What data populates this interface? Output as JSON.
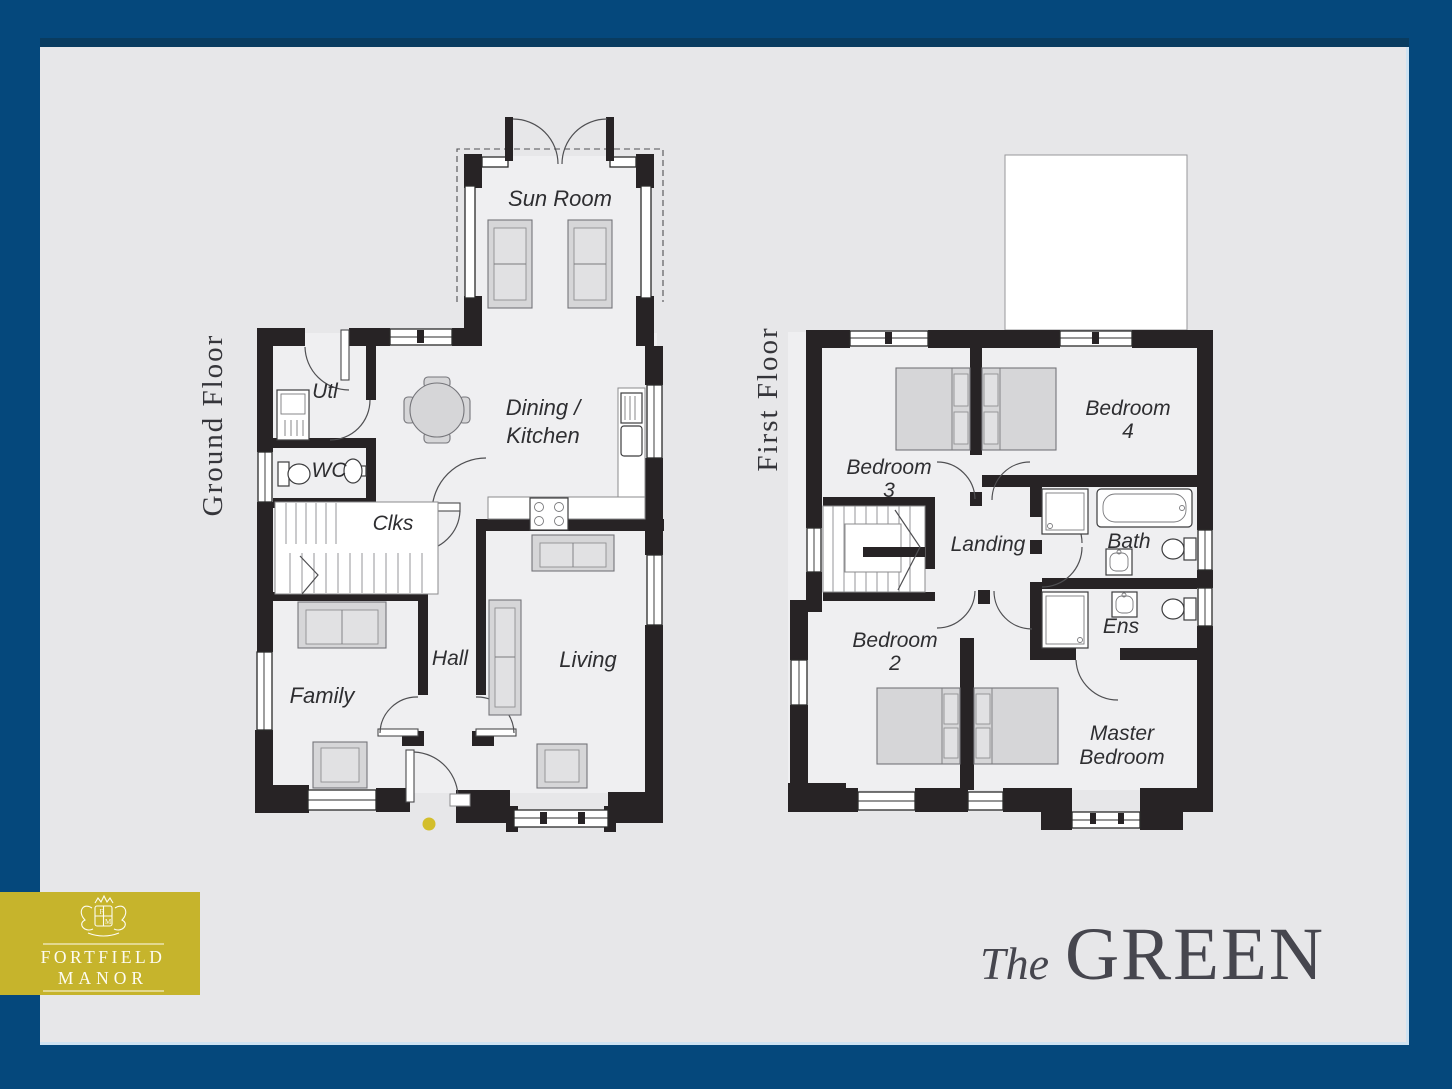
{
  "brand": {
    "name_line1": "FORTFIELD",
    "name_line2": "MANOR"
  },
  "plot": {
    "prefix": "The",
    "name": "GREEN"
  },
  "ground_floor": {
    "title": "Ground Floor",
    "sun_room": "Sun Room",
    "utility": "Utl",
    "wc": "WC",
    "cloaks": "Clks",
    "dining_kitchen_line1": "Dining /",
    "dining_kitchen_line2": "Kitchen",
    "hall": "Hall",
    "family": "Family",
    "living": "Living"
  },
  "first_floor": {
    "title": "First Floor",
    "bedroom3_line1": "Bedroom",
    "bedroom3_line2": "3",
    "bedroom4_line1": "Bedroom",
    "bedroom4_line2": "4",
    "landing": "Landing",
    "bath": "Bath",
    "bedroom2_line1": "Bedroom",
    "bedroom2_line2": "2",
    "ensuite": "Ens",
    "master_line1": "Master",
    "master_line2": "Bedroom"
  },
  "colors": {
    "frame_blue": "#05487c",
    "panel_grey": "#e7e7e9",
    "wall_black": "#272325",
    "brand_gold": "#c6b42c",
    "accent_dot": "#d3be2b",
    "title_grey": "#46464e"
  }
}
